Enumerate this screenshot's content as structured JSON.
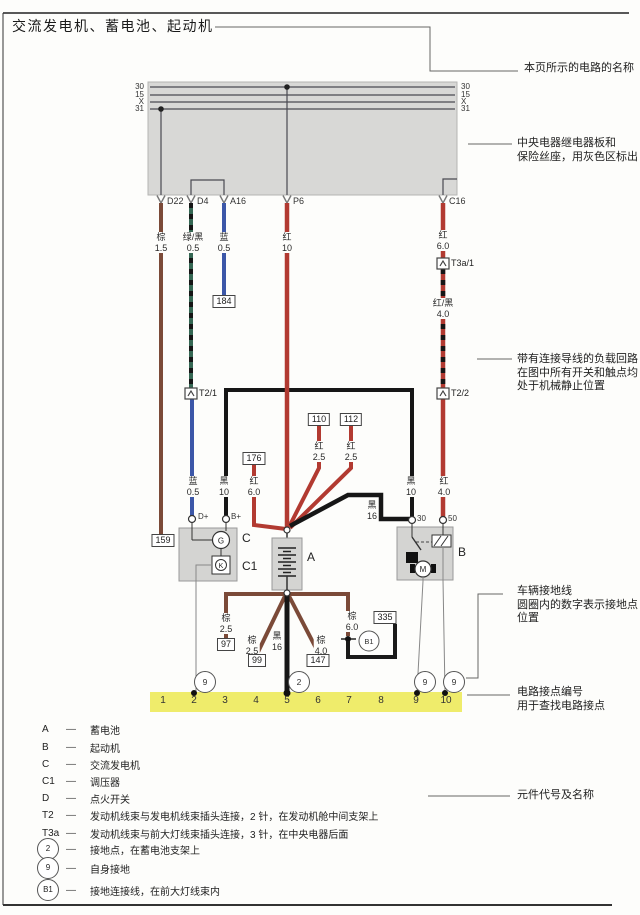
{
  "colors": {
    "red": "#b23a31",
    "brown": "#7b4a38",
    "blue": "#3c57a8",
    "green": "#356753",
    "black": "#161616",
    "graybox": "#d8d8d6",
    "compfill": "#d4d4d2",
    "yellow": "#efec6b"
  },
  "title": "交流发电机、蓄电池、起动机",
  "bus_labels": [
    "30",
    "15",
    "X",
    "31"
  ],
  "terminals": [
    "D22",
    "D4",
    "A16",
    "P6",
    "C16"
  ],
  "connectors": {
    "t2_1": "T2/1",
    "t3a_1": "T3a/1",
    "t2_2": "T2/2"
  },
  "pins": {
    "dplus": "D+",
    "bplus": "B+",
    "t30": "30",
    "t50": "50"
  },
  "components": {
    "a": "A",
    "b": "B",
    "c": "C",
    "c1": "C1",
    "g": "G",
    "k": "K",
    "m": "M"
  },
  "wire_labels": {
    "d22": {
      "color": "棕",
      "size": "1.5"
    },
    "d4": {
      "color": "绿/黑",
      "size": "0.5"
    },
    "a16": {
      "color": "蓝",
      "size": "0.5"
    },
    "p6": {
      "color": "红",
      "size": "10"
    },
    "c16_upper": {
      "color": "红",
      "size": "6.0"
    },
    "c16_mid": {
      "color": "红/黑",
      "size": "4.0"
    },
    "c16_lower": {
      "color": "红",
      "size": "4.0"
    },
    "d4_lower": {
      "color": "蓝",
      "size": "0.5"
    },
    "alt_b": {
      "color": "黑",
      "size": "10"
    },
    "starter_30": {
      "color": "黑",
      "size": "10"
    },
    "w176": {
      "color": "红",
      "size": "6.0"
    },
    "w110": {
      "color": "红",
      "size": "2.5"
    },
    "w112": {
      "color": "红",
      "size": "2.5"
    },
    "black16": {
      "color": "黑",
      "size": "16"
    },
    "gnd_97": {
      "color": "棕",
      "size": "2.5"
    },
    "gnd_99": {
      "color": "棕",
      "size": "2.5"
    },
    "gnd_black": {
      "color": "黑",
      "size": "16"
    },
    "gnd_147": {
      "color": "棕",
      "size": "4.0"
    },
    "gnd_b1": {
      "color": "棕",
      "size": "6.0"
    }
  },
  "number_boxes": {
    "n159": "159",
    "n184": "184",
    "n176": "176",
    "n110": "110",
    "n112": "112",
    "n97": "97",
    "n99": "99",
    "n147": "147",
    "n335": "335"
  },
  "grounds": {
    "g2": "2",
    "g9": "9",
    "b1": "B1"
  },
  "tracks": [
    "1",
    "2",
    "3",
    "4",
    "5",
    "6",
    "7",
    "8",
    "9",
    "10"
  ],
  "annotations": {
    "circuit_name": "本页所示的电路的名称",
    "panel_1": "中央电器继电器板和",
    "panel_2": "保险丝座，用灰色区标出",
    "load_1": "带有连接导线的负载回路",
    "load_2": "在图中所有开关和触点均",
    "load_3": "处于机械静止位置",
    "ground_1": "车辆接地线",
    "ground_2": "圆圈内的数字表示接地点",
    "ground_3": "位置",
    "contact_1": "电路接点编号",
    "contact_2": "用于查找电路接点",
    "legend_title": "元件代号及名称"
  },
  "legend": {
    "dash": "—",
    "rows": [
      {
        "key": "A",
        "text": "蓄电池"
      },
      {
        "key": "B",
        "text": "起动机"
      },
      {
        "key": "C",
        "text": "交流发电机"
      },
      {
        "key": "C1",
        "text": "调压器"
      },
      {
        "key": "D",
        "text": "点火开关"
      },
      {
        "key": "T2",
        "text": "发动机线束与发电机线束插头连接，2 针，在发动机舱中间支架上"
      },
      {
        "key": "T3a",
        "text": "发动机线束与前大灯线束插头连接，3 针，在中央电器后面"
      },
      {
        "key": "2",
        "text": "接地点，在蓄电池支架上"
      },
      {
        "key": "9",
        "text": "自身接地"
      },
      {
        "key": "B1",
        "text": "接地连接线，在前大灯线束内"
      }
    ]
  }
}
